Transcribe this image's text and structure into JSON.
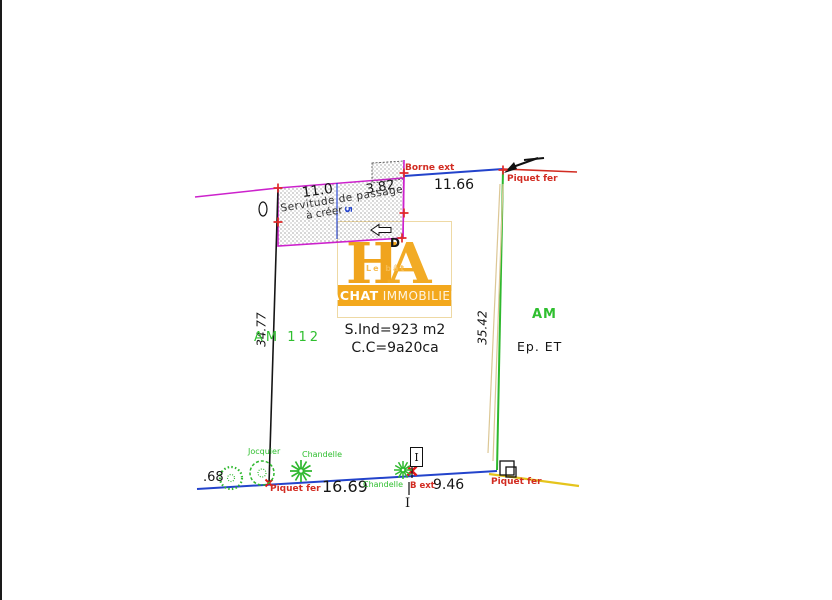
{
  "plan": {
    "borne_ext": "Borne ext",
    "piquet_fer_top": "Piquet fer",
    "dim_top": "11.66",
    "dim_strip": "3.82",
    "dim_servitude": "11.0",
    "servitude_l1": "Servitude de passage",
    "servitude_l2": "à créer",
    "servitude_mark": "5",
    "label_d": "D",
    "dim_left": "34.77",
    "parcel_left": "AM 112",
    "area_line1": "S.Ind=923 m2",
    "area_line2": "C.C=9a20ca",
    "dim_right": "35.42",
    "section_right": "AM",
    "ep_label": "Ep.  ET",
    "dim_cut_left": ".68",
    "piquet_fer_bottom_left": "Piquet fer",
    "dim_bottom_left": "16.69",
    "tree_jocquier": "Jocquier",
    "tree_chandelle_1": "Chandelle",
    "tree_chandelle_2": "Chandelle",
    "borne_b_ext": "B ext",
    "dim_bottom_right": "9.46",
    "piquet_fer_bottom_right": "Piquet fer",
    "marker_i_box": "I",
    "marker_i_below": "I"
  },
  "logo": {
    "monogram_h": "H",
    "monogram_a": "A",
    "tagline": "Le  bât",
    "banner_word1": "ACHAT",
    "banner_word2": "IMMOBILIER"
  },
  "colors": {
    "boundary_black": "#161616",
    "servitude_magenta": "#cc22cc",
    "line_blue": "#2343cb",
    "line_red": "#d22c22",
    "line_green": "#2eb82e",
    "line_yellow": "#e5c41c",
    "hedge_tan": "#dcc795",
    "logo_gold": "#f3a81d"
  }
}
